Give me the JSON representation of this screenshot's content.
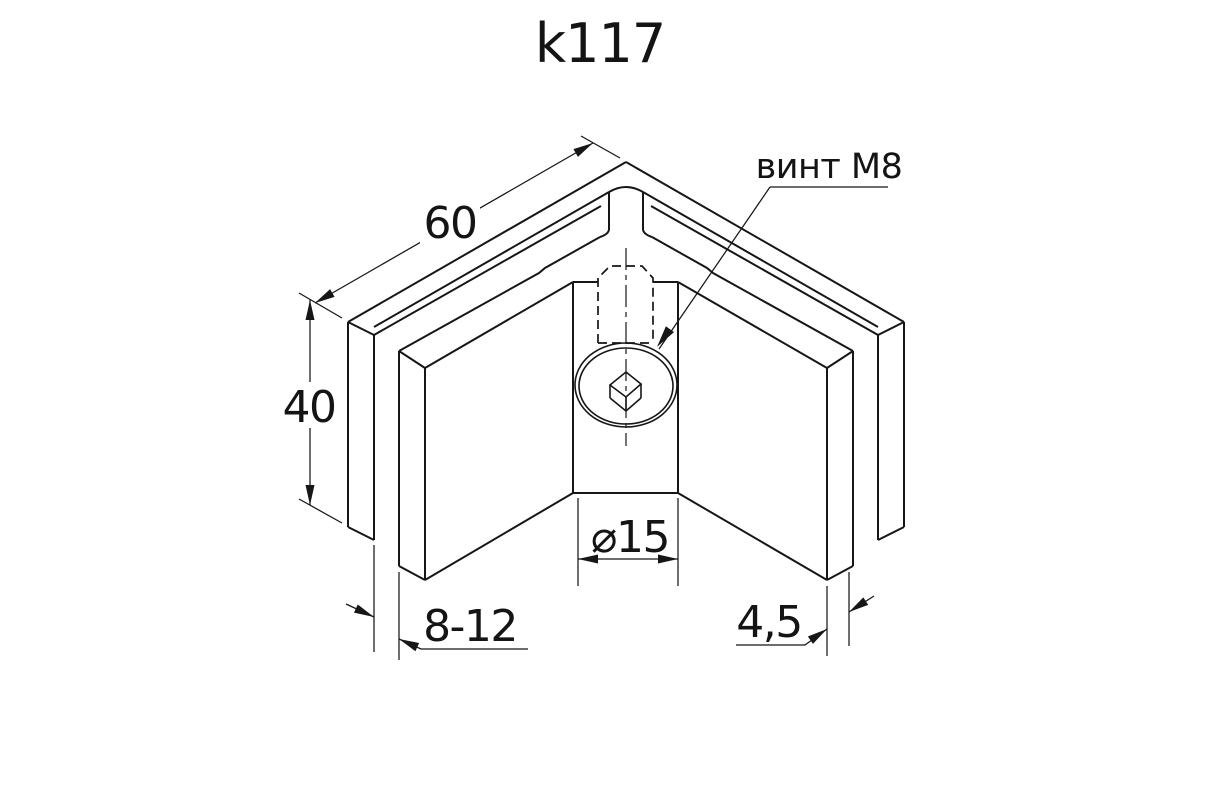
{
  "page": {
    "background": "#ffffff",
    "line_color": "#161616"
  },
  "title": {
    "text": "k117"
  },
  "annotations": {
    "screw_label": {
      "text": "винт М8"
    }
  },
  "dimensions": {
    "width": {
      "value": "60"
    },
    "height": {
      "value": "40"
    },
    "glass_thickness": {
      "value": "8-12"
    },
    "head_diameter": {
      "value": "⌀15"
    },
    "plate_thickness": {
      "value": "4,5"
    }
  }
}
